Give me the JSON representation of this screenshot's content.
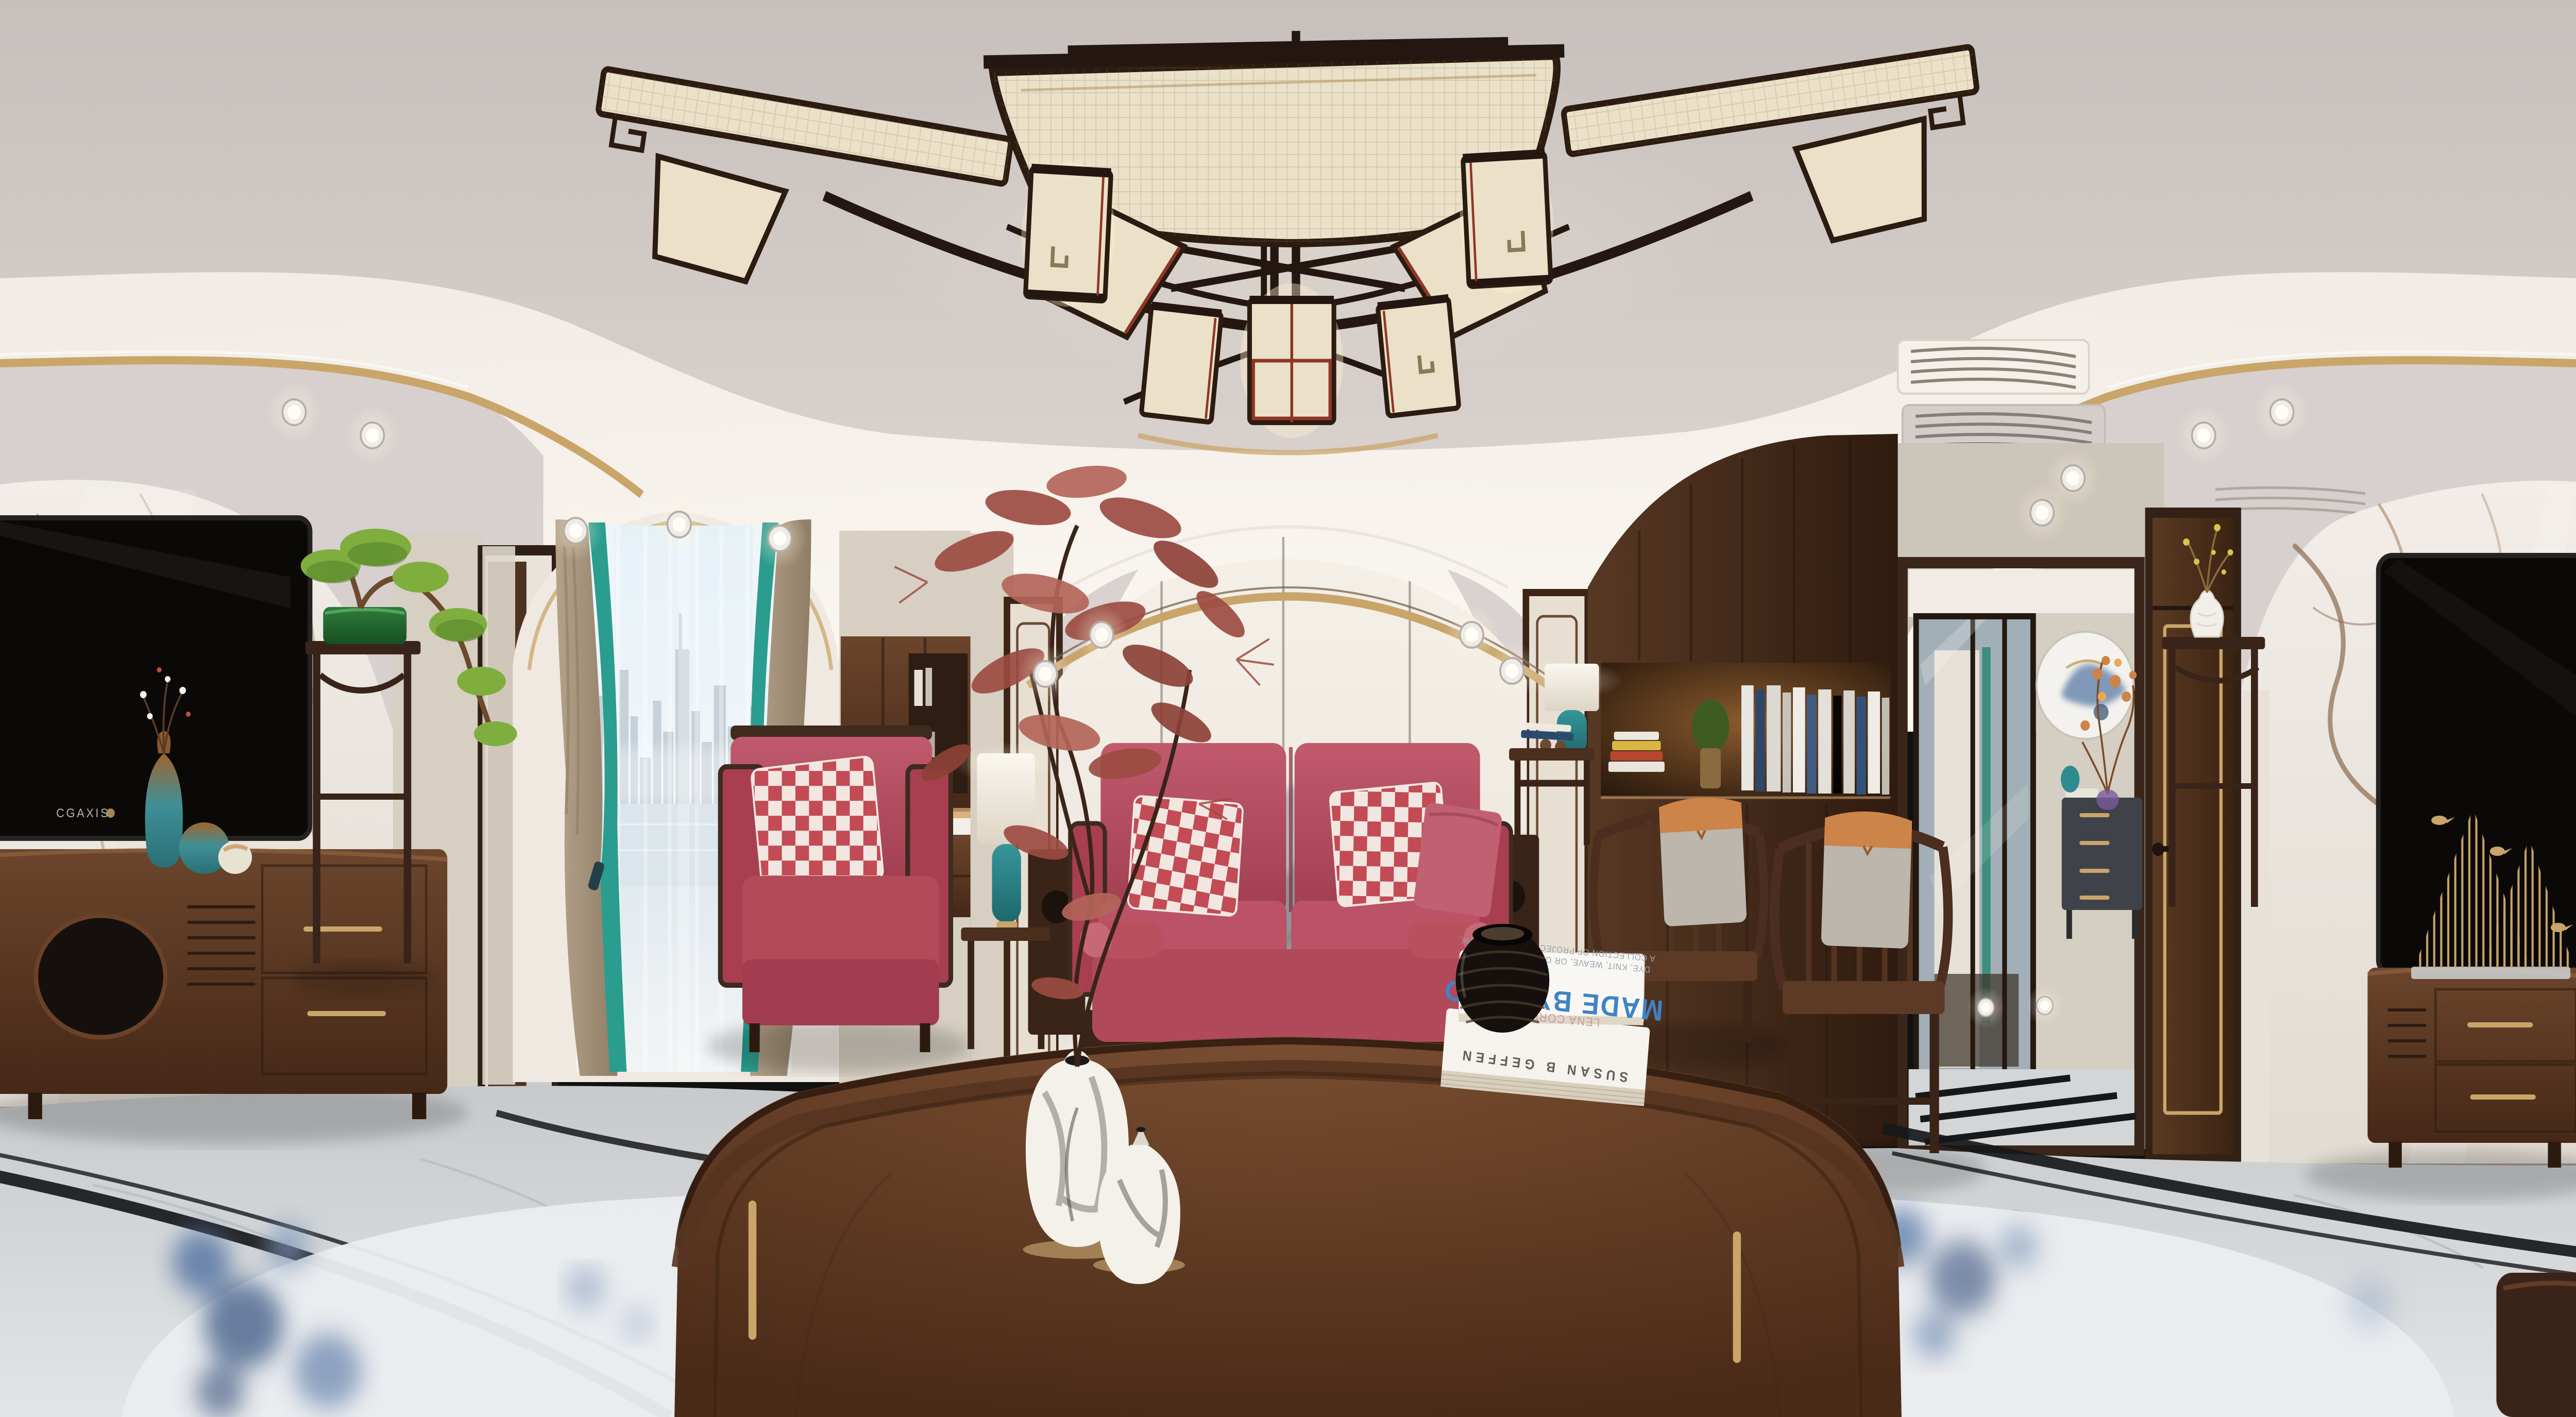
{
  "scene": {
    "title": "New Chinese style living room - 360 degree equirectangular panorama",
    "labels": {
      "tv_brand": "CGAXIS",
      "book_author": "LENA CORWIN'S",
      "book_title": "MADE BY HAND",
      "book_subtitle_line1": "A COLLECTION OF PROJECTS TO PRINT, SEW,",
      "book_subtitle_line2": "DYE, KNIT, WEAVE, OR OTHERWISE CREATE",
      "book_spine": "SUSAN B GEFFEN"
    },
    "palette": {
      "ceilGray": "#c9c1be",
      "ceilGrayDeep": "#d9d2ce",
      "coveWhite": "#f6f1ea",
      "soffit": "#d7d0cf",
      "gold": "#c9a56a",
      "marbleWall": "#f0eae4",
      "marbleVein": "#9d8063",
      "wallBeige": "#d6cfc2",
      "wallBeige2": "#ccc5b9",
      "woodDark": "#3a2315",
      "woodMid": "#5d3b25",
      "woodDeep": "#2c1a0e",
      "muralBase": "#f2ece4",
      "mountainInk": "#70747b",
      "sofaRed": "#b34a5a",
      "sofaDeep": "#9e3b4c",
      "pillowCheck": "#c24b55",
      "lampTeal": "#2e8b8f",
      "lampShade": "#f6f2e8",
      "bonsaiGreen": "#7fae3e",
      "potGreen": "#2e7a38",
      "mapleRed": "#9c4c42",
      "curtainTeal": "#2a9d8f",
      "curtainTan": "#b3a089",
      "floorGray": "#cfd2d3",
      "inlayBlack": "#17181a",
      "rugWhite": "#eaecef",
      "rugBlue": "#4f6fa0",
      "tvBlack": "#0b0908",
      "accentOrange": "#cd8448",
      "lanternCream": "#eae1c8",
      "lanternRed": "#8f3527",
      "skyBlue": "#d8e8f1",
      "glassBlue": "#aebdc6",
      "titleBlue": "#3f83c6"
    }
  }
}
